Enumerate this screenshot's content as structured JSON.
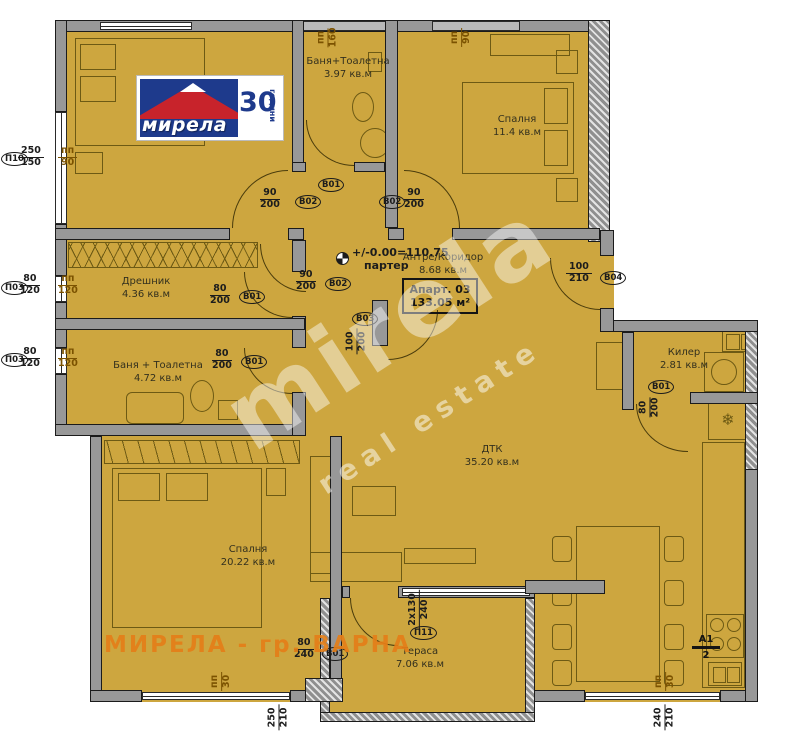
{
  "logo": {
    "brand": "мирела",
    "years": "30",
    "years_suffix": "години"
  },
  "watermarks": {
    "diag1": "mirela",
    "diag2": "real estate",
    "city": "МИРЕЛА - гр. ВАРНА"
  },
  "level": {
    "value": "+/-0.00=110.75",
    "floor": "партер"
  },
  "apartment": {
    "name": "Апарт. 03",
    "area": "133.05 м²"
  },
  "rooms": {
    "bath_top": {
      "name": "Баня+Тоалетна",
      "area": "3.97 кв.м"
    },
    "bedroom_tr": {
      "name": "Спалня",
      "area": "11.4 кв.м"
    },
    "dressing": {
      "name": "Дрешник",
      "area": "4.36 кв.м"
    },
    "bath_left": {
      "name": "Баня + Тоалетна",
      "area": "4.72 кв.м"
    },
    "hall": {
      "name": "Антре/Коридор",
      "area": "8.68 кв.м"
    },
    "pantry": {
      "name": "Килер",
      "area": "2.81 кв.м"
    },
    "living": {
      "name": "ДТК",
      "area": "35.20 кв.м"
    },
    "bedroom_bl": {
      "name": "Спалня",
      "area": "20.22 кв.м"
    },
    "terrace": {
      "name": "Тераса",
      "area": "7.06 кв.м"
    }
  },
  "openings": {
    "p10": {
      "id": "П10",
      "top": "250",
      "bottom": "150"
    },
    "p10_pp": {
      "top": "пп",
      "bottom": "90"
    },
    "p03a": {
      "id": "П03",
      "top": "80",
      "bottom": "120"
    },
    "p03a_pp": {
      "top": "пп",
      "bottom": "120"
    },
    "p03b": {
      "id": "П03",
      "top": "80",
      "bottom": "120"
    },
    "p03b_pp": {
      "top": "пп",
      "bottom": "120"
    },
    "pp160_top": {
      "top": "пп",
      "bottom": "160"
    },
    "pp90_top_right": {
      "top": "пп",
      "bottom": "90"
    },
    "b01_bath_top": {
      "id": "В01"
    },
    "b02_bed_left": {
      "id": "В02",
      "top": "90",
      "bottom": "200"
    },
    "b02_bed_right": {
      "id": "В02",
      "top": "90",
      "bottom": "200"
    },
    "b02_hall": {
      "id": "В02",
      "top": "90",
      "bottom": "200"
    },
    "b01_dressing": {
      "id": "В01",
      "top": "80",
      "bottom": "200"
    },
    "b01_bath_left": {
      "id": "В01",
      "top": "80",
      "bottom": "200"
    },
    "b03": {
      "id": "В03",
      "top": "100",
      "bottom": "200"
    },
    "b04": {
      "id": "В04",
      "top": "100",
      "bottom": "210"
    },
    "b01_pantry": {
      "id": "В01",
      "top": "80",
      "bottom": "200"
    },
    "p11": {
      "id": "П11",
      "top": "2x130",
      "bottom": "240"
    },
    "b01_terrace": {
      "id": "В01",
      "top": "80",
      "bottom": "240"
    },
    "a1": {
      "top": "A1",
      "bottom": "2"
    },
    "pp30_left": {
      "top": "пп",
      "bottom": "30"
    },
    "pp30_right": {
      "top": "пп",
      "bottom": "30"
    },
    "dim_bottom_left": {
      "top": "250",
      "bottom": "210"
    },
    "dim_bottom_right": {
      "top": "240",
      "bottom": "210"
    }
  },
  "icons": {
    "fridge": "❄"
  },
  "colors": {
    "floor": "#cda63f",
    "wall": "#989898",
    "logo_blue": "#1e3a8c",
    "logo_red": "#c8232b",
    "watermark_orange": "#e47e18"
  }
}
